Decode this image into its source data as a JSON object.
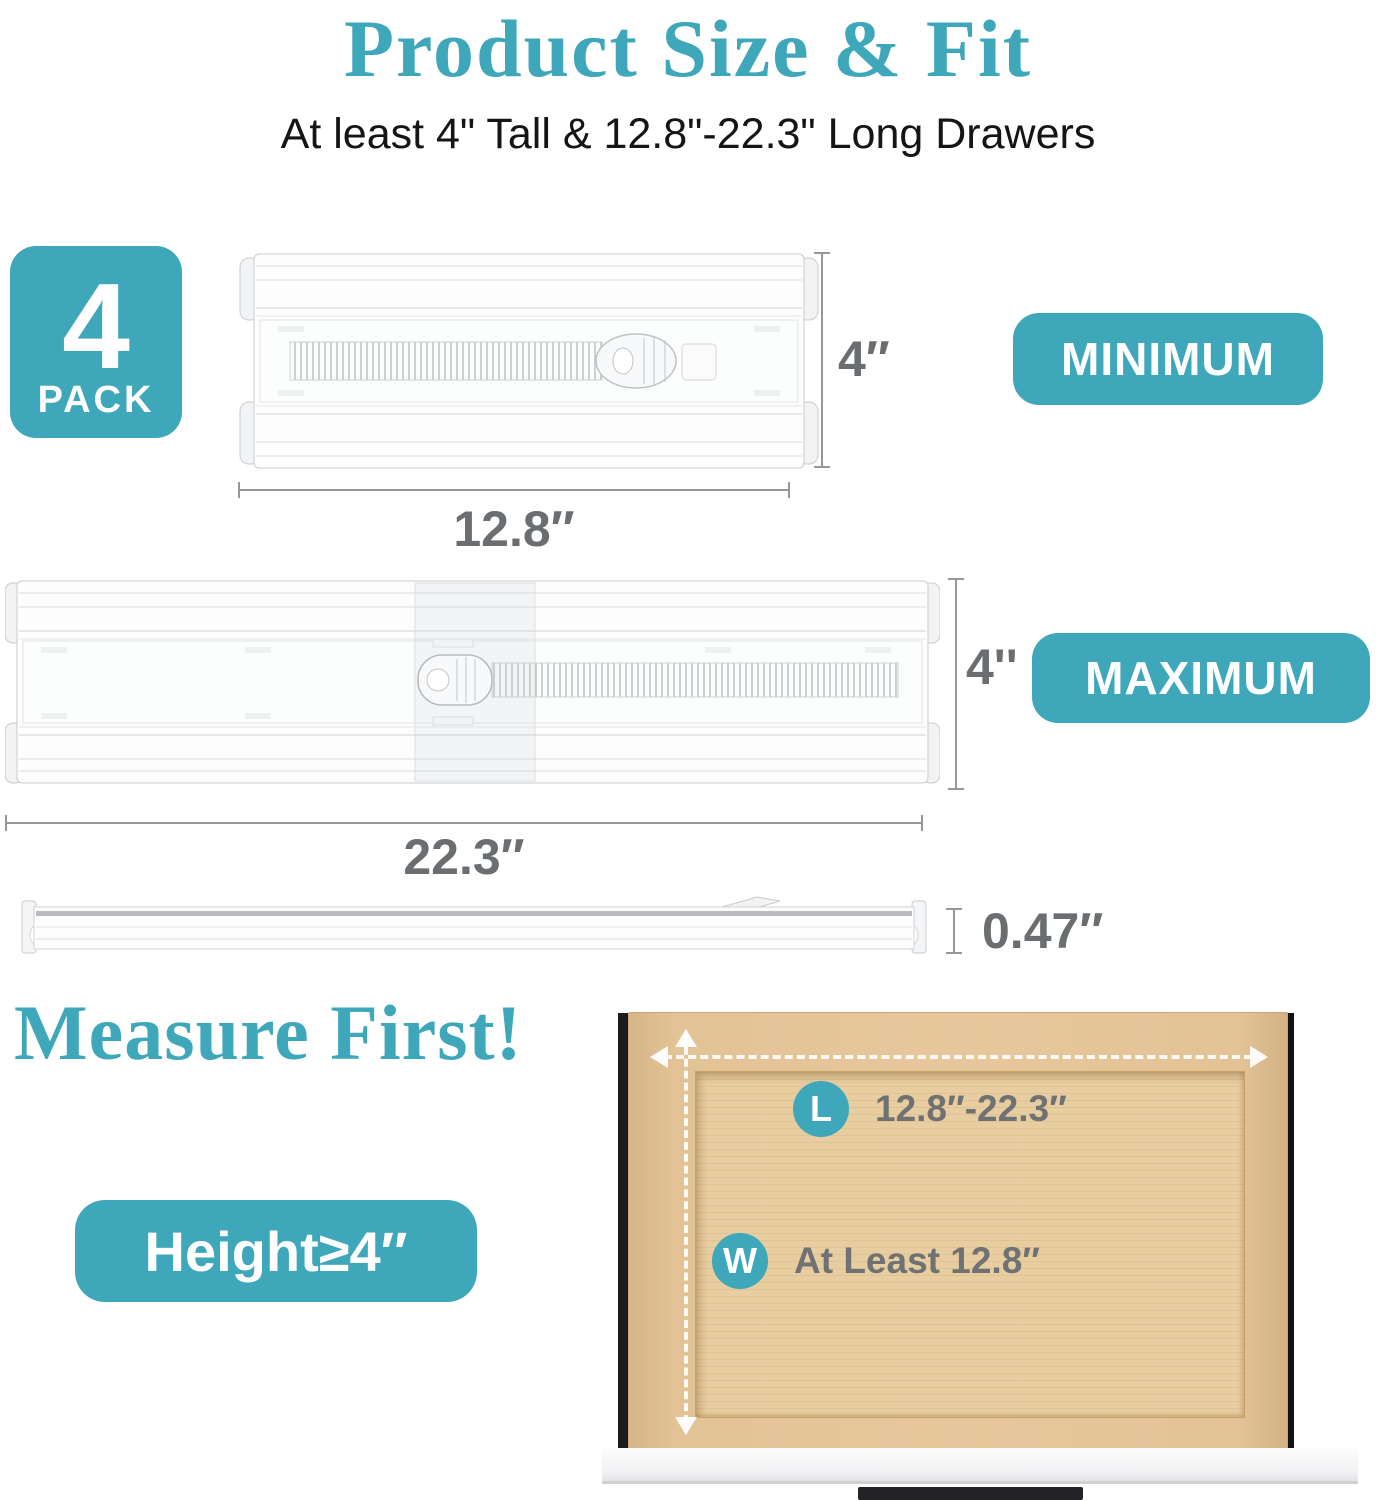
{
  "title": "Product Size & Fit",
  "subtitle": "At least 4\" Tall & 12.8\"-22.3\" Long Drawers",
  "pack_badge": {
    "count": "4",
    "label": "PACK"
  },
  "min_row": {
    "height_label": "4″",
    "length_label": "12.8″",
    "badge_label": "MINIMUM"
  },
  "max_row": {
    "height_label": "4''",
    "length_label": "22.3″",
    "badge_label": "MAXIMUM"
  },
  "thickness_row": {
    "thickness_label": "0.47″"
  },
  "measure": {
    "heading": "Measure First!",
    "height_badge_label": "Height≥4″",
    "drawer": {
      "length_marker": "L",
      "length_value": "12.8″-22.3″",
      "width_marker": "W",
      "width_value": "At Least 12.8″"
    }
  },
  "colors": {
    "teal": "#3fa7ba",
    "dimension_gray": "#95989b",
    "label_gray": "#6b6e70",
    "wood_tan": "#e8cda0"
  }
}
